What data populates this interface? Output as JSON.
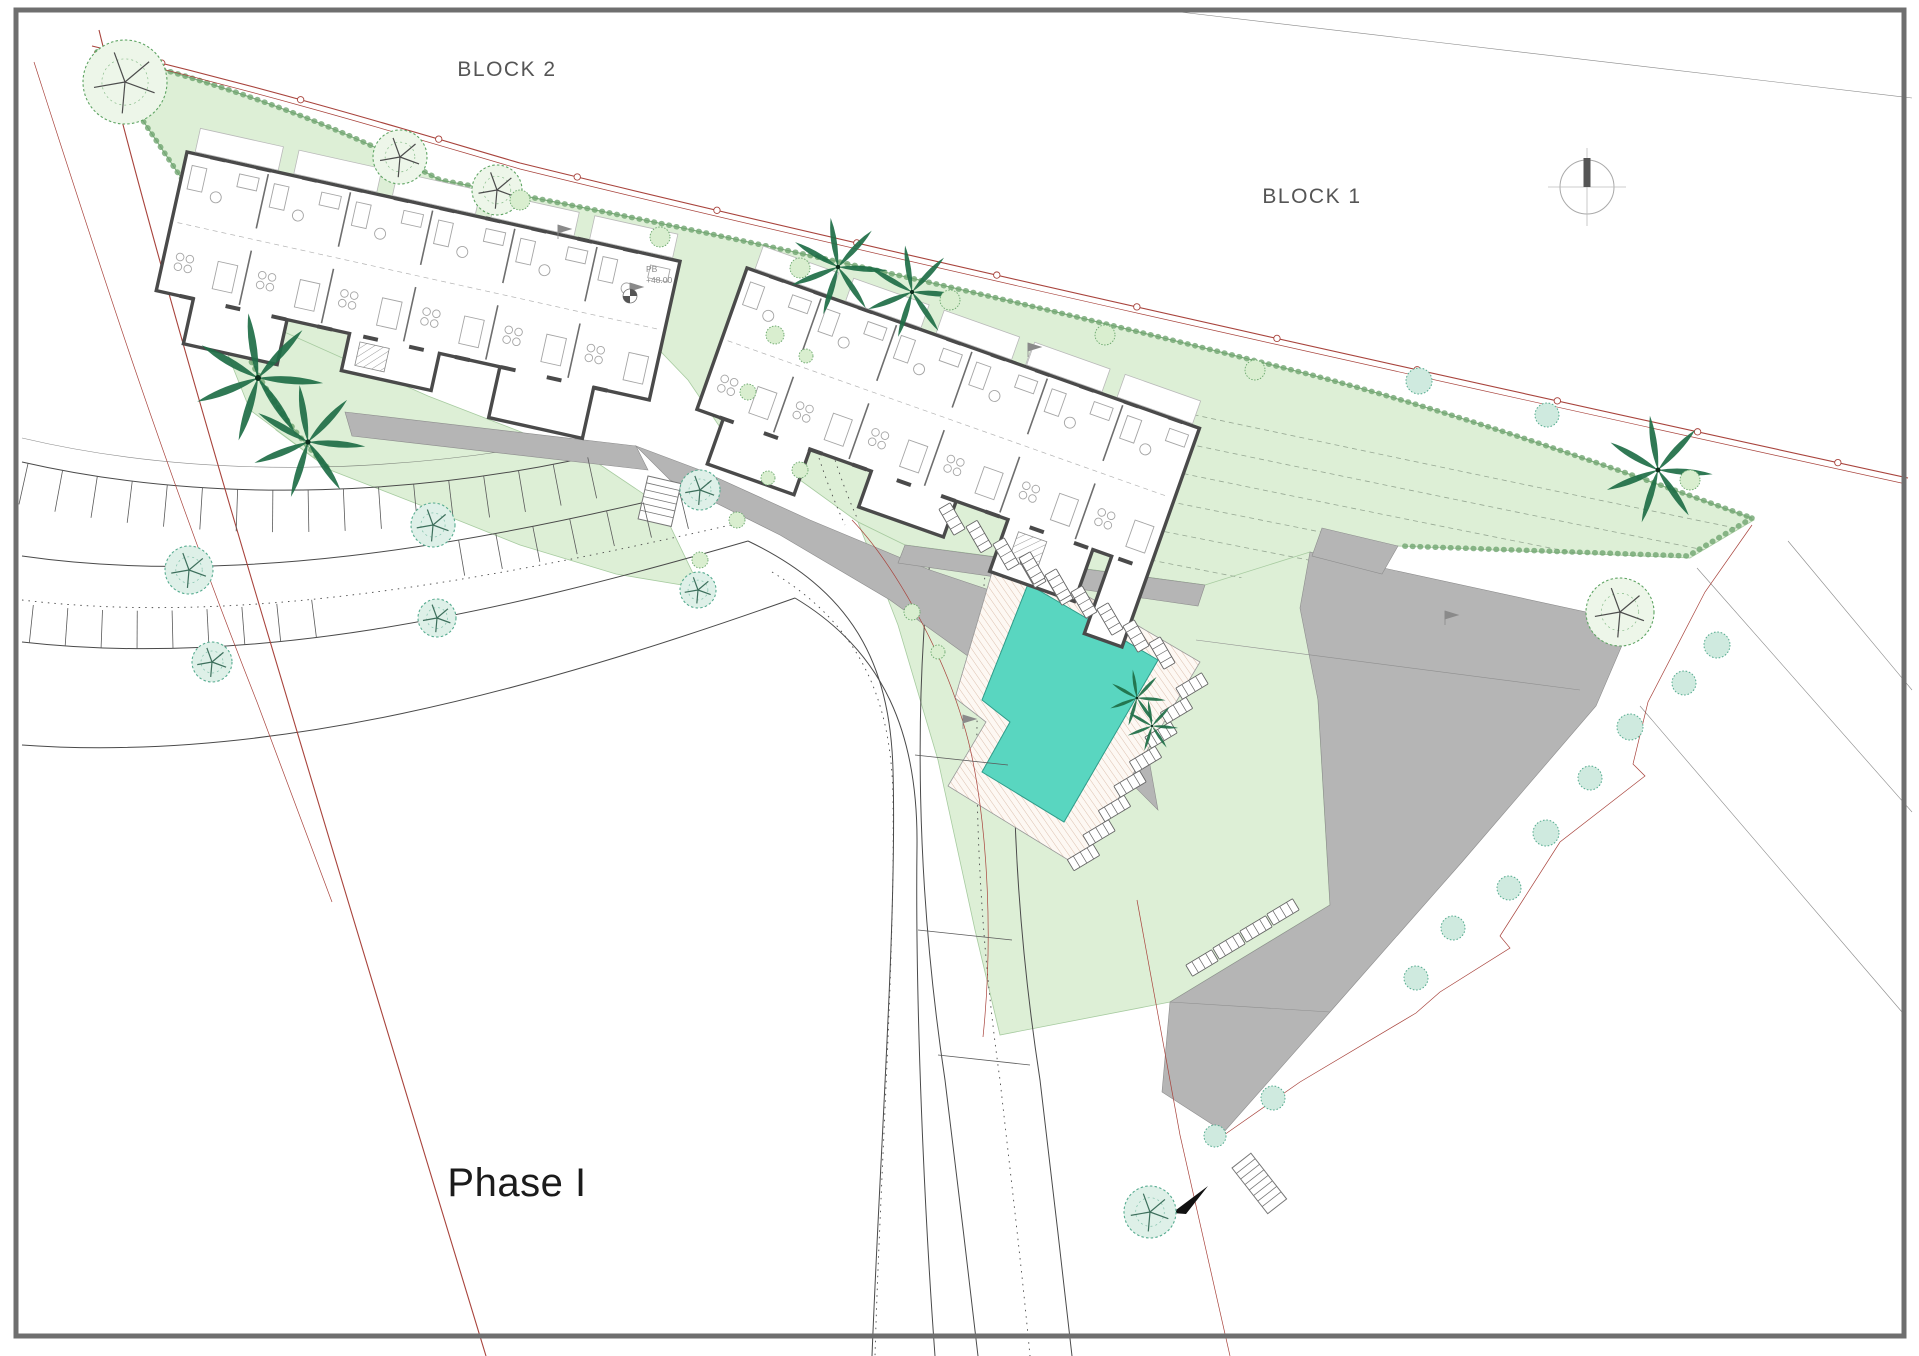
{
  "title": "Residential development site plan - Phase I",
  "labels": {
    "block2": "BLOCK 2",
    "block1": "BLOCK 1",
    "phase": "Phase I",
    "level_line1": "PB",
    "level_line2": "+48.00"
  },
  "colors": {
    "paper": "#ffffff",
    "frame": "#6f6f6f",
    "lawn": "#ddefd6",
    "lawn_stroke": "#a7cba0",
    "hedge": "#71a571",
    "contour": "#97a894",
    "pool": "#59d6c0",
    "pool_stroke": "#2f9c8a",
    "deck_stripe": "#dcc0ae",
    "asphalt": "#b5b5b5",
    "wall": "#4a4a4a",
    "furniture": "#a5a5a5",
    "boundary_red": "#a8433c",
    "road_line": "#4a4a4a",
    "tree_green": "#5ea463",
    "tree_teal": "#57ac90",
    "palm": "#1e6e46",
    "text": "#555555"
  },
  "compass": {
    "x": 1587,
    "y": 187,
    "r": 27
  },
  "level_marker": {
    "x": 646,
    "y": 272
  },
  "trees": {
    "palms": [
      {
        "x": 258,
        "y": 378,
        "s": 1.25
      },
      {
        "x": 308,
        "y": 442,
        "s": 1.1
      },
      {
        "x": 838,
        "y": 267,
        "s": 0.95
      },
      {
        "x": 912,
        "y": 292,
        "s": 0.9
      },
      {
        "x": 1658,
        "y": 470,
        "s": 1.05
      },
      {
        "x": 1137,
        "y": 698,
        "s": 0.55
      },
      {
        "x": 1152,
        "y": 726,
        "s": 0.5
      }
    ],
    "deciduous": [
      {
        "x": 125,
        "y": 82,
        "r": 42
      },
      {
        "x": 400,
        "y": 157,
        "r": 27
      },
      {
        "x": 497,
        "y": 190,
        "r": 25
      },
      {
        "x": 1620,
        "y": 612,
        "r": 34
      }
    ],
    "street": [
      {
        "x": 189,
        "y": 570,
        "r": 24
      },
      {
        "x": 433,
        "y": 525,
        "r": 22
      },
      {
        "x": 700,
        "y": 490,
        "r": 20
      },
      {
        "x": 212,
        "y": 662,
        "r": 20
      },
      {
        "x": 437,
        "y": 618,
        "r": 19
      },
      {
        "x": 698,
        "y": 590,
        "r": 18
      },
      {
        "x": 1150,
        "y": 1212,
        "r": 26
      }
    ],
    "boundary": [
      {
        "x": 1419,
        "y": 381,
        "r": 13
      },
      {
        "x": 1547,
        "y": 415,
        "r": 12
      },
      {
        "x": 1717,
        "y": 645,
        "r": 13
      },
      {
        "x": 1684,
        "y": 683,
        "r": 12
      },
      {
        "x": 1630,
        "y": 727,
        "r": 13
      },
      {
        "x": 1590,
        "y": 778,
        "r": 12
      },
      {
        "x": 1546,
        "y": 833,
        "r": 13
      },
      {
        "x": 1509,
        "y": 888,
        "r": 12
      },
      {
        "x": 1453,
        "y": 928,
        "r": 12
      },
      {
        "x": 1416,
        "y": 978,
        "r": 12
      },
      {
        "x": 1273,
        "y": 1098,
        "r": 12
      },
      {
        "x": 1215,
        "y": 1136,
        "r": 11
      }
    ],
    "hedge_shrubs": [
      {
        "x": 520,
        "y": 200,
        "r": 10
      },
      {
        "x": 660,
        "y": 237,
        "r": 10
      },
      {
        "x": 800,
        "y": 268,
        "r": 10
      },
      {
        "x": 950,
        "y": 300,
        "r": 10
      },
      {
        "x": 1105,
        "y": 335,
        "r": 10
      },
      {
        "x": 1255,
        "y": 370,
        "r": 10
      },
      {
        "x": 1690,
        "y": 480,
        "r": 10
      }
    ],
    "courtyard_shrubs": [
      {
        "x": 775,
        "y": 335,
        "r": 9
      },
      {
        "x": 748,
        "y": 392,
        "r": 8
      },
      {
        "x": 800,
        "y": 470,
        "r": 8
      },
      {
        "x": 768,
        "y": 478,
        "r": 7
      },
      {
        "x": 806,
        "y": 356,
        "r": 7
      },
      {
        "x": 737,
        "y": 520,
        "r": 8
      },
      {
        "x": 700,
        "y": 560,
        "r": 8
      },
      {
        "x": 912,
        "y": 612,
        "r": 8
      },
      {
        "x": 938,
        "y": 652,
        "r": 7
      }
    ]
  },
  "loungers": {
    "rows": [
      {
        "x": 952,
        "y": 519,
        "dx": 27,
        "dy": 17.5,
        "n": 5,
        "rot": -30
      },
      {
        "x": 1032,
        "y": 568,
        "dx": 26,
        "dy": 17,
        "n": 6,
        "rot": -30
      },
      {
        "x": 1192,
        "y": 686,
        "dx": -15.5,
        "dy": 24.5,
        "n": 8,
        "rot": 59
      },
      {
        "x": 1283,
        "y": 912,
        "dx": -27,
        "dy": 17,
        "n": 4,
        "rot": 59
      }
    ]
  },
  "parking_stalls": {
    "rows": [
      {
        "path": "rA",
        "n": 17,
        "len": 42,
        "side": 1,
        "from": 0.01,
        "to": 0.92
      },
      {
        "path": "rC",
        "n": 9,
        "len": 38,
        "side": -1,
        "from": 0.01,
        "to": 0.4
      },
      {
        "path": "rB",
        "n": 7,
        "len": 36,
        "side": 1,
        "from": 0.64,
        "to": 0.97
      }
    ],
    "road_cross_lines": [
      [
        915,
        755,
        1008,
        765
      ],
      [
        918,
        930,
        1012,
        940
      ],
      [
        938,
        1055,
        1030,
        1065
      ]
    ]
  },
  "survey_points": {
    "count": 13
  },
  "mini_pools": {
    "x": 835,
    "y": 384,
    "rot": 17
  },
  "buildings": {
    "block2": {
      "bays": 6
    },
    "block1": {
      "bays": 6
    }
  }
}
